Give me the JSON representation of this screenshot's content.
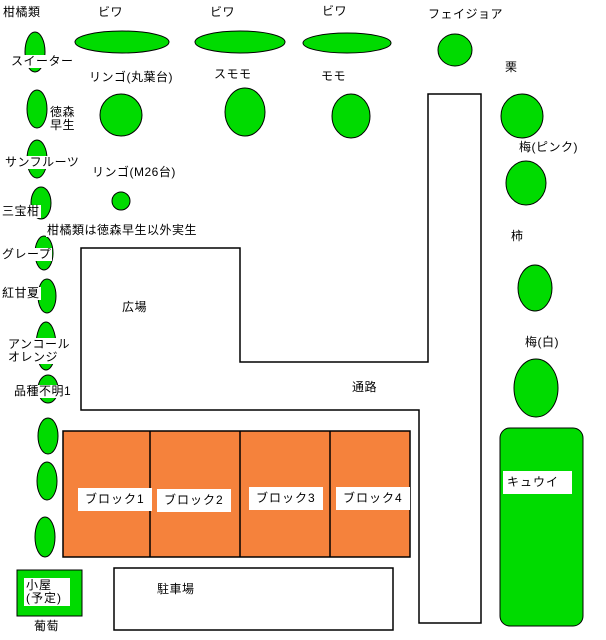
{
  "colors": {
    "tree_green": "#00DB00",
    "block_orange": "#F5823C",
    "outline": "#000000",
    "background": "#FFFFFF"
  },
  "header": {
    "citrus_group_label": "柑橘類"
  },
  "note": "柑橘類は徳森早生以外実生",
  "trees": {
    "biwa1": "ビワ",
    "biwa2": "ビワ",
    "biwa3": "ビワ",
    "feijoa": "フェイジョア",
    "sweeter": "スイーター",
    "apple_marubadai": "リンゴ(丸葉台)",
    "sumomo": "スモモ",
    "momo": "モモ",
    "kuri": "栗",
    "tokumori_wase": "徳森\n早生",
    "sun_fruits": "サンフルーツ",
    "apple_m26": "リンゴ(M26台)",
    "ume_pink": "梅(ピンク)",
    "sanbokan": "三宝柑",
    "kaki": "柿",
    "grape_citrus": "グレープ",
    "beni_amanatsu": "紅甘夏",
    "encore_orange": "アンコール\nオレンジ",
    "hinshu_fumei1": "品種不明1",
    "kiwi": "キュウイ",
    "ume_white": "梅(白)",
    "budou": "葡萄"
  },
  "areas": {
    "hiroba": "広場",
    "tsuro": "通路",
    "parking": "駐車場",
    "koya": "小屋\n(予定)"
  },
  "blocks": [
    {
      "label": "ブロック1"
    },
    {
      "label": "ブロック2"
    },
    {
      "label": "ブロック3"
    },
    {
      "label": "ブロック4"
    }
  ]
}
